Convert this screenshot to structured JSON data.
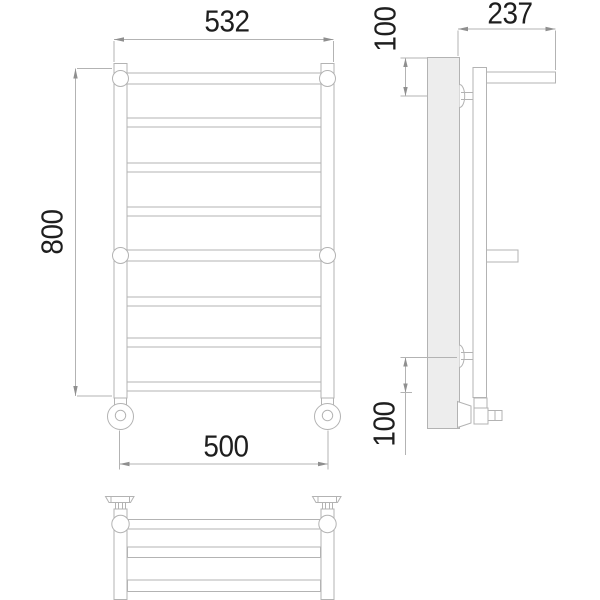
{
  "title": "Heated towel rail technical drawing",
  "dimensions": {
    "top_width": "532",
    "overall_height": "800",
    "bottom_width": "500",
    "depth": "237",
    "top_offset": "100",
    "bottom_offset": "100"
  },
  "colors": {
    "line": "#b3b3b3",
    "tick": "#8f8f8f",
    "text": "#1e1e1e",
    "plate": "#ededed",
    "background": "#ffffff"
  }
}
